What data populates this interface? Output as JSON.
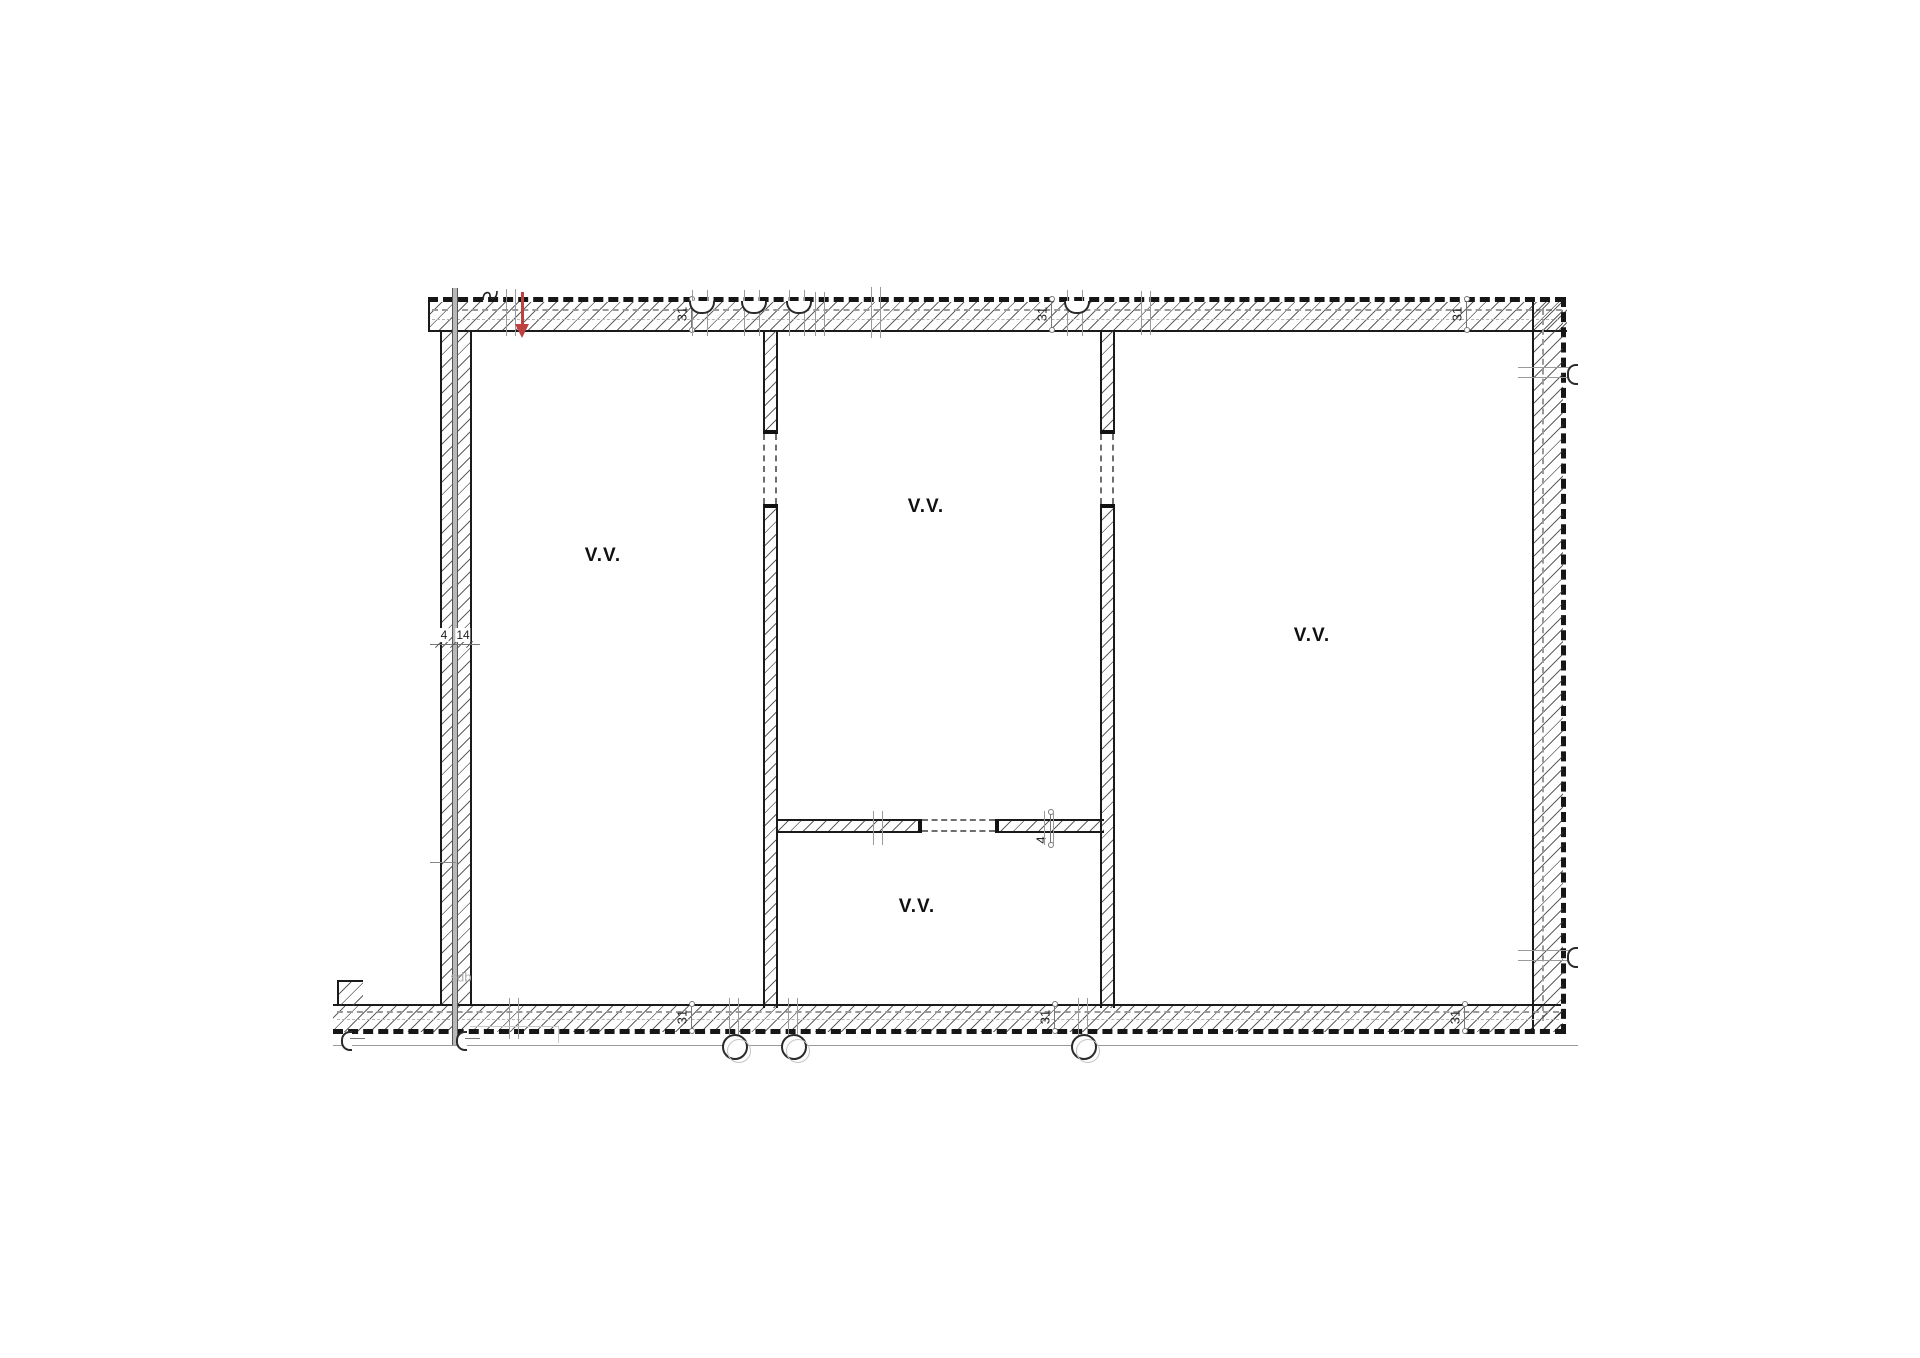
{
  "rooms": {
    "left_label": "V.V.",
    "middle_label": "V.V.",
    "bottom_label": "V.V.",
    "right_label": "V.V.",
    "adjacent_label": "sdb"
  },
  "dimensions": {
    "wall_thickness": "31",
    "party_wall_outer": "4",
    "party_wall_inner": "14",
    "partition_thickness": "4"
  },
  "colors": {
    "entrance_arrow": "#bf4040",
    "wall_line": "#1a1a1a",
    "aux_gray": "#9a9a9a"
  }
}
